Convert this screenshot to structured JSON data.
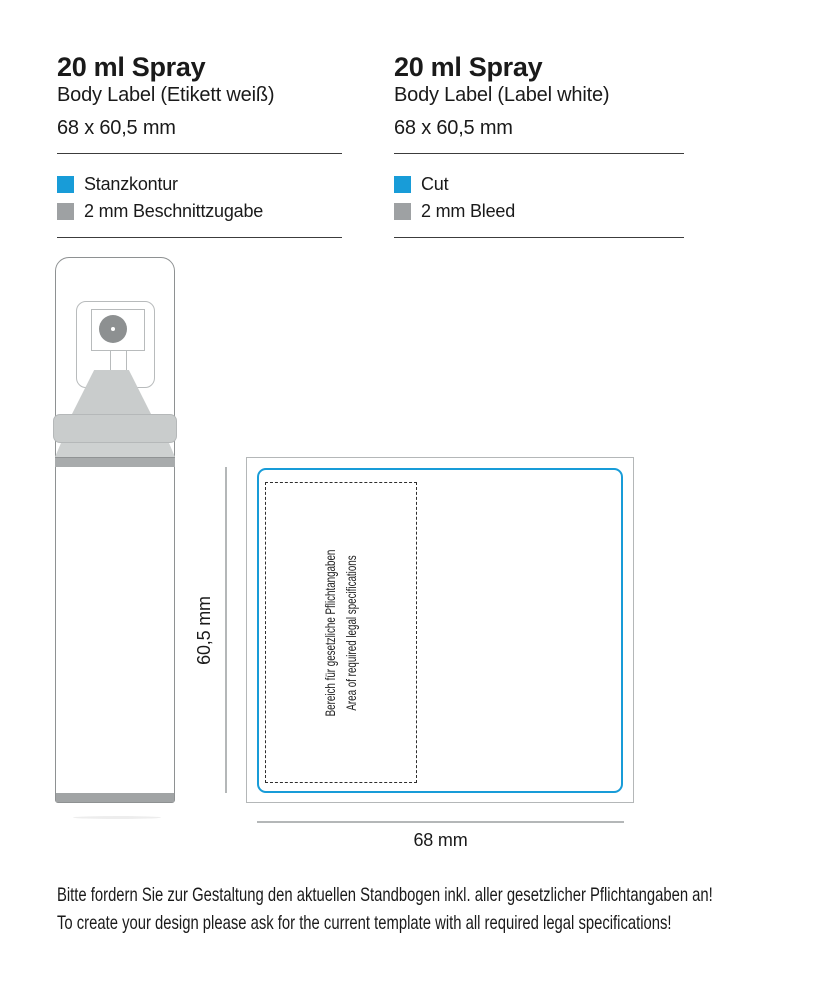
{
  "colors": {
    "cut_line": "#189cd8",
    "bleed_swatch": "#9ea1a3"
  },
  "header_columns": [
    {
      "title": "20 ml Spray",
      "subtitle": "Body Label (Etikett weiß)",
      "size": "68 x 60,5 mm",
      "legend": [
        {
          "label": "Stanzkontur"
        },
        {
          "label": "2 mm Beschnittzugabe"
        }
      ]
    },
    {
      "title": "20 ml Spray",
      "subtitle": "Body Label (Label white)",
      "size": "68 x 60,5 mm",
      "legend": [
        {
          "label": "Cut"
        },
        {
          "label": "2 mm Bleed"
        }
      ]
    }
  ],
  "dieline": {
    "height_label": "60,5 mm",
    "width_label": "68 mm",
    "legal_area": {
      "line_de": "Bereich für gesetzliche Pflichtangaben",
      "line_en": "Area of required legal specifications"
    }
  },
  "footer": {
    "line_de": "Bitte fordern Sie zur Gestaltung den aktuellen Standbogen inkl. aller gesetzlicher Pflichtangaben an!",
    "line_en": "To create your design please ask for the current template with all required legal specifications!"
  }
}
